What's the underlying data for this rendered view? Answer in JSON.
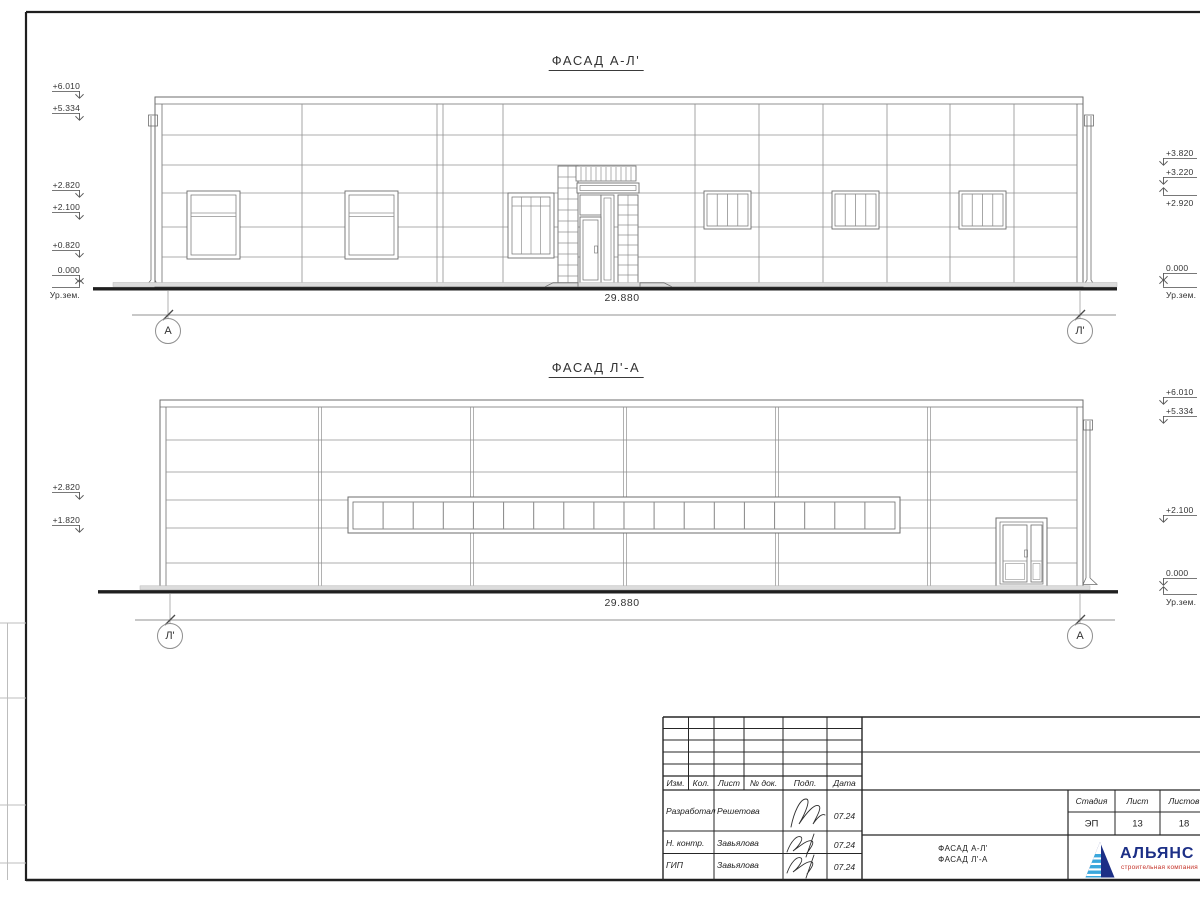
{
  "facade1": {
    "title": "ФАСАД А-Л'",
    "dimension": "29.880",
    "axis_left": "А",
    "axis_right": "Л'",
    "marks_left": [
      "+6.010",
      "+5.334",
      "+2.820",
      "+2.100",
      "+0.820",
      "0.000",
      "Ур.зем."
    ],
    "marks_right": [
      "+3.820",
      "+3.220",
      "+2.920",
      "0.000",
      "Ур.зем."
    ]
  },
  "facade2": {
    "title": "ФАСАД Л'-А",
    "dimension": "29.880",
    "axis_left": "Л'",
    "axis_right": "А",
    "marks_left": [
      "+2.820",
      "+1.820"
    ],
    "marks_right": [
      "+6.010",
      "+5.334",
      "+2.100",
      "0.000",
      "Ур.зем."
    ]
  },
  "titleblock": {
    "header_cols": [
      "Изм.",
      "Кол.",
      "Лист",
      "№ док.",
      "Подп.",
      "Дата"
    ],
    "rows": [
      {
        "role": "Разработал",
        "name": "Решетова",
        "date": "07.24"
      },
      {
        "role": "Н. контр.",
        "name": "Завьялова",
        "date": "07.24"
      },
      {
        "role": "ГИП",
        "name": "Завьялова",
        "date": "07.24"
      }
    ],
    "stage_label": "Стадия",
    "sheet_label": "Лист",
    "sheets_label": "Листов",
    "stage": "ЭП",
    "sheet_num": "13",
    "sheets_total": "18",
    "doc_title_line1": "ФАСАД А-Л'",
    "doc_title_line2": "ФАСАД Л'-А",
    "logo_name": "АЛЬЯНС",
    "logo_tagline": "строительная компания"
  },
  "colors": {
    "line": "#6e6e6e",
    "thin": "#909090",
    "dark": "#1f1f1f",
    "apron_fill": "#dcdcdc",
    "logo_navy": "#1c2f86",
    "logo_blue": "#3aa7dc",
    "logo_red": "#c43127"
  }
}
